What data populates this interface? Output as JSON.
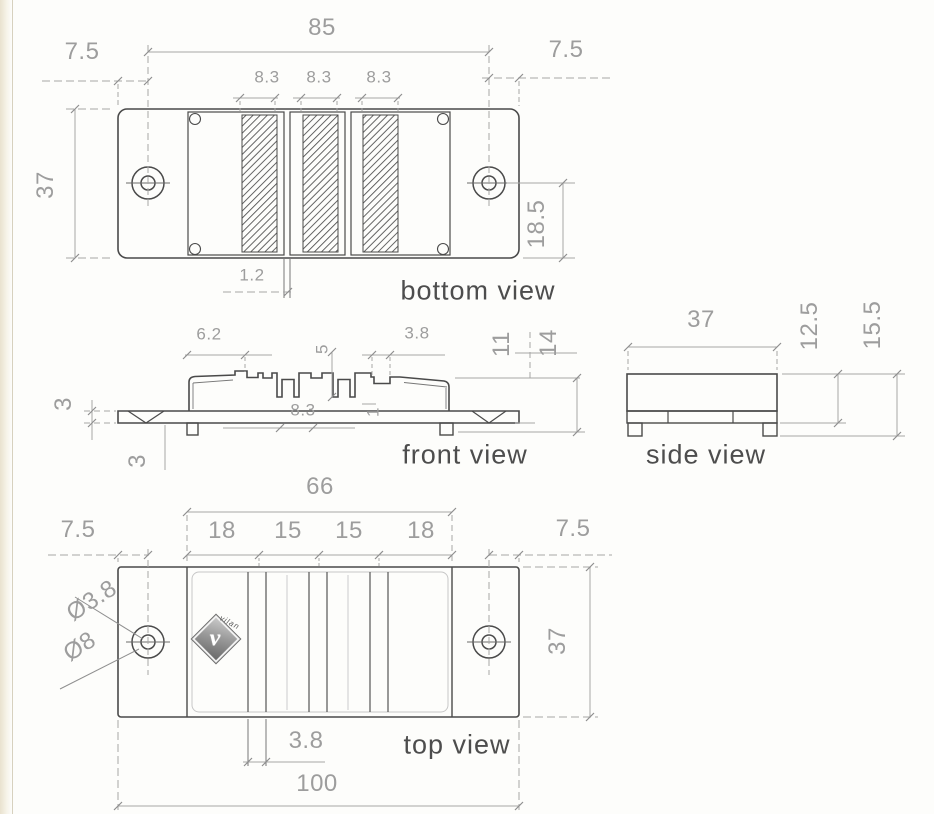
{
  "drawing": {
    "views": {
      "bottom": {
        "label": "bottom view",
        "dim_85": "85",
        "dim_75_left": "7.5",
        "dim_75_right": "7.5",
        "strip_dims": [
          "8.3",
          "8.3",
          "8.3"
        ],
        "dim_37": "37",
        "dim_185": "18.5",
        "dim_12": "1.2"
      },
      "front": {
        "label": "front view",
        "dim_62": "6.2",
        "dim_5": "5",
        "dim_38": "3.8",
        "dim_11": "11",
        "dim_14": "14",
        "dim_3_top": "3",
        "dim_3_bottom": "3",
        "dim_83": "8.3",
        "dim_1": "1"
      },
      "side": {
        "label": "side view",
        "dim_37": "37",
        "dim_125": "12.5",
        "dim_155": "15.5"
      },
      "top": {
        "label": "top view",
        "dim_66": "66",
        "sections": [
          "18",
          "15",
          "15",
          "18"
        ],
        "dim_75_left": "7.5",
        "dim_75_right": "7.5",
        "dia_inner": "Ø3.8",
        "dia_outer": "Ø8",
        "dim_37": "37",
        "dim_38": "3.8",
        "dim_100": "100",
        "logo_text": "vilan",
        "logo_glyph": "v"
      }
    },
    "colors": {
      "outline": "#4a4a4a",
      "dim_line": "#a6a6a6",
      "dim_text": "#9d9d9d",
      "title_text": "#4d4d4d",
      "paper": "#fdfdfb"
    }
  }
}
